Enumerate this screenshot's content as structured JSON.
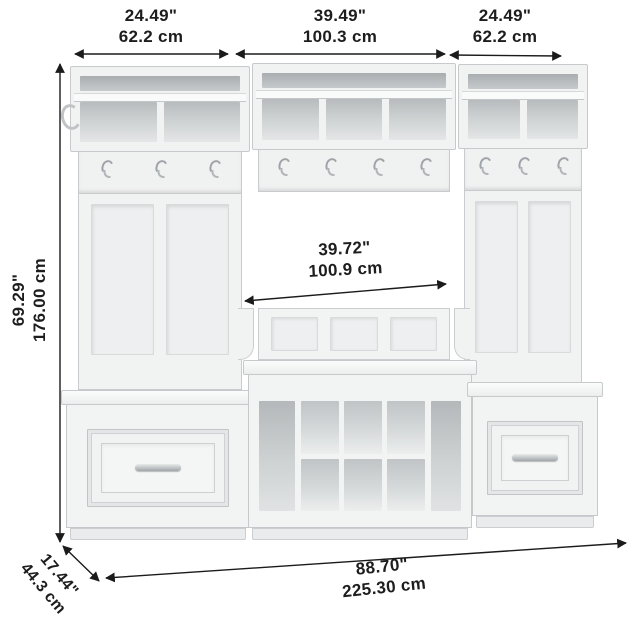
{
  "dim": {
    "top_left": {
      "in": "24.49\"",
      "cm": "62.2 cm"
    },
    "top_middle": {
      "in": "39.49\"",
      "cm": "100.3 cm"
    },
    "top_right": {
      "in": "24.49\"",
      "cm": "62.2 cm"
    },
    "height": {
      "in": "69.29\"",
      "cm": "176.00 cm"
    },
    "opening": {
      "in": "39.72\"",
      "cm": "100.9 cm"
    },
    "total_width": {
      "in": "88.70\"",
      "cm": "225.30 cm"
    },
    "depth": {
      "in": "17.44\"",
      "cm": "44.3 cm"
    }
  },
  "furniture": {
    "left_unit": {
      "hooks": 3,
      "cubbies": 2,
      "back_panels": 2,
      "drawers": 1
    },
    "middle_unit": {
      "hooks": 4,
      "cubbies": 3,
      "back_panels": 3,
      "shoe_cubbies": 6,
      "open_compartments": 2
    },
    "right_unit": {
      "hooks": 3,
      "cubbies": 2,
      "back_panels": 2,
      "drawers": 1
    },
    "side_hooks": 1
  },
  "colors": {
    "background": "#ffffff",
    "furniture": "#f2f3f3",
    "recess": "#c3c7c9",
    "dimension_line": "#1b1b1b",
    "metal": "#a0a6a9"
  }
}
